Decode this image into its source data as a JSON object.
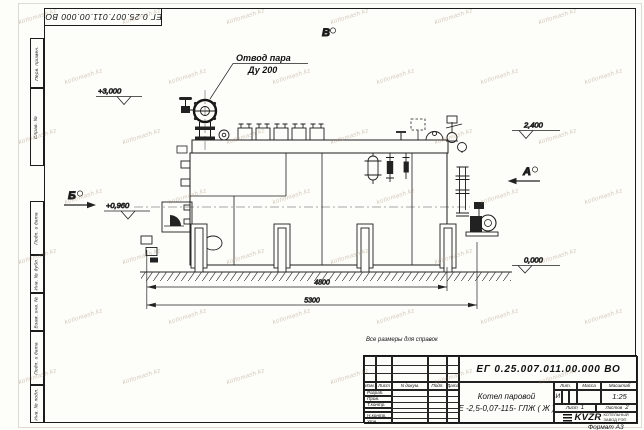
{
  "watermark": {
    "text": "kotlomash.kz"
  },
  "frame": {
    "top_stamp": "ЕГ 0.25.007.011.00.000  ВО",
    "left_fields": [
      "Перв. примен.",
      "Справ. №",
      "Подп. и дата",
      "Инв. № дубл.",
      "Взам. инв. №",
      "Подп. и дата",
      "Инв. № подл."
    ],
    "format_note": "Формат А3"
  },
  "drawing": {
    "callout": {
      "line1": "Отвод пара",
      "line2": "Ду 200"
    },
    "view_markers": {
      "a": "А",
      "b": "Б",
      "v": "В"
    },
    "elevations": {
      "e3000": "+3,000",
      "e0960": "+0,960",
      "e2400": "2,400",
      "e0000": "0,000"
    },
    "dimensions": {
      "d4800": "4800",
      "d5300": "5300"
    }
  },
  "note": "Все размеры для справок",
  "title_block": {
    "doc_number": "ЕГ 0.25.007.011.00.000  ВО",
    "product_name_line1": "Котел паровой",
    "product_name_line2": "Е -2,5-0,07-115- ГЛЖ ( Ж )",
    "header_cols": [
      "Изм.",
      "Лист",
      "N докум.",
      "Подп.",
      "Дата"
    ],
    "row_labels": [
      "Разраб.",
      "Пров.",
      "Т.контр.",
      "",
      "Н.контр.",
      "Утв."
    ],
    "lit_label": "Лит.",
    "lit_value": "И",
    "mass_label": "Масса",
    "scale_label": "Масштаб",
    "scale_value": "1:25",
    "sheet_label": "Лист",
    "sheet_value": "1",
    "sheets_label": "Листов",
    "sheets_value": "2",
    "logo_text": "KVZR",
    "logo_sub1": "КОТЕЛЬНЫЙ",
    "logo_sub2": "ЗАВОД РЭП"
  }
}
